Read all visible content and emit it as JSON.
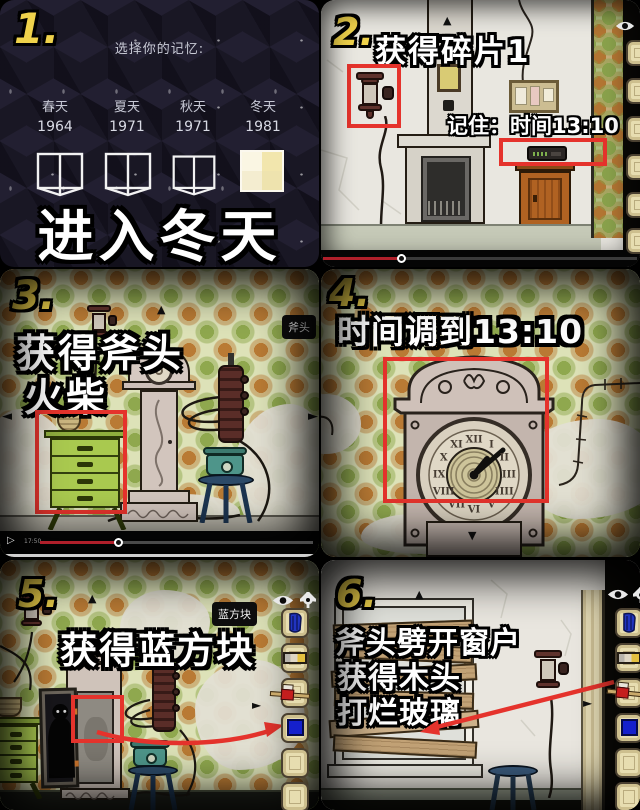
{
  "panel1": {
    "number": "1.",
    "prompt": "选择你的记忆:",
    "seasons": [
      {
        "name": "春天",
        "year": "1964"
      },
      {
        "name": "夏天",
        "year": "1971"
      },
      {
        "name": "秋天",
        "year": "1971"
      },
      {
        "name": "冬天",
        "year": "1981"
      }
    ],
    "caption": "进入冬天"
  },
  "panel2": {
    "number": "2.",
    "caption": "获得碎片1",
    "note": "记住：时间13:10"
  },
  "panel3": {
    "number": "3.",
    "caption_line1": "获得斧头",
    "caption_line2": "火柴",
    "tooltip": "斧头",
    "player_time": "17:50"
  },
  "panel4": {
    "number": "4.",
    "caption": "时间调到13:10",
    "clock_numerals": [
      "XII",
      "I",
      "II",
      "III",
      "IIII",
      "V",
      "VI",
      "VII",
      "VIII",
      "IX",
      "X",
      "XI"
    ]
  },
  "panel5": {
    "number": "5.",
    "caption": "获得蓝方块",
    "tooltip": "蓝方块"
  },
  "panel6": {
    "number": "6.",
    "caption_line1": "斧头劈开窗户",
    "caption_line2": "获得木头",
    "caption_line3": "打烂玻璃"
  },
  "glyphs": {
    "up_triangle": "▲",
    "down_triangle": "▼",
    "left_nav": "◄",
    "right_nav": "►",
    "play": "▷"
  },
  "inventory_items": [
    "blue-gloves",
    "matchbox",
    "axe",
    "blue-cube",
    "empty",
    "empty"
  ],
  "colors": {
    "highlight_red": "#e5332c",
    "number_yellow": "#efd24b",
    "progress_red": "#b01f2a",
    "blue_cube": "#1520cc",
    "wallpaper_green": "#dde2b8"
  }
}
